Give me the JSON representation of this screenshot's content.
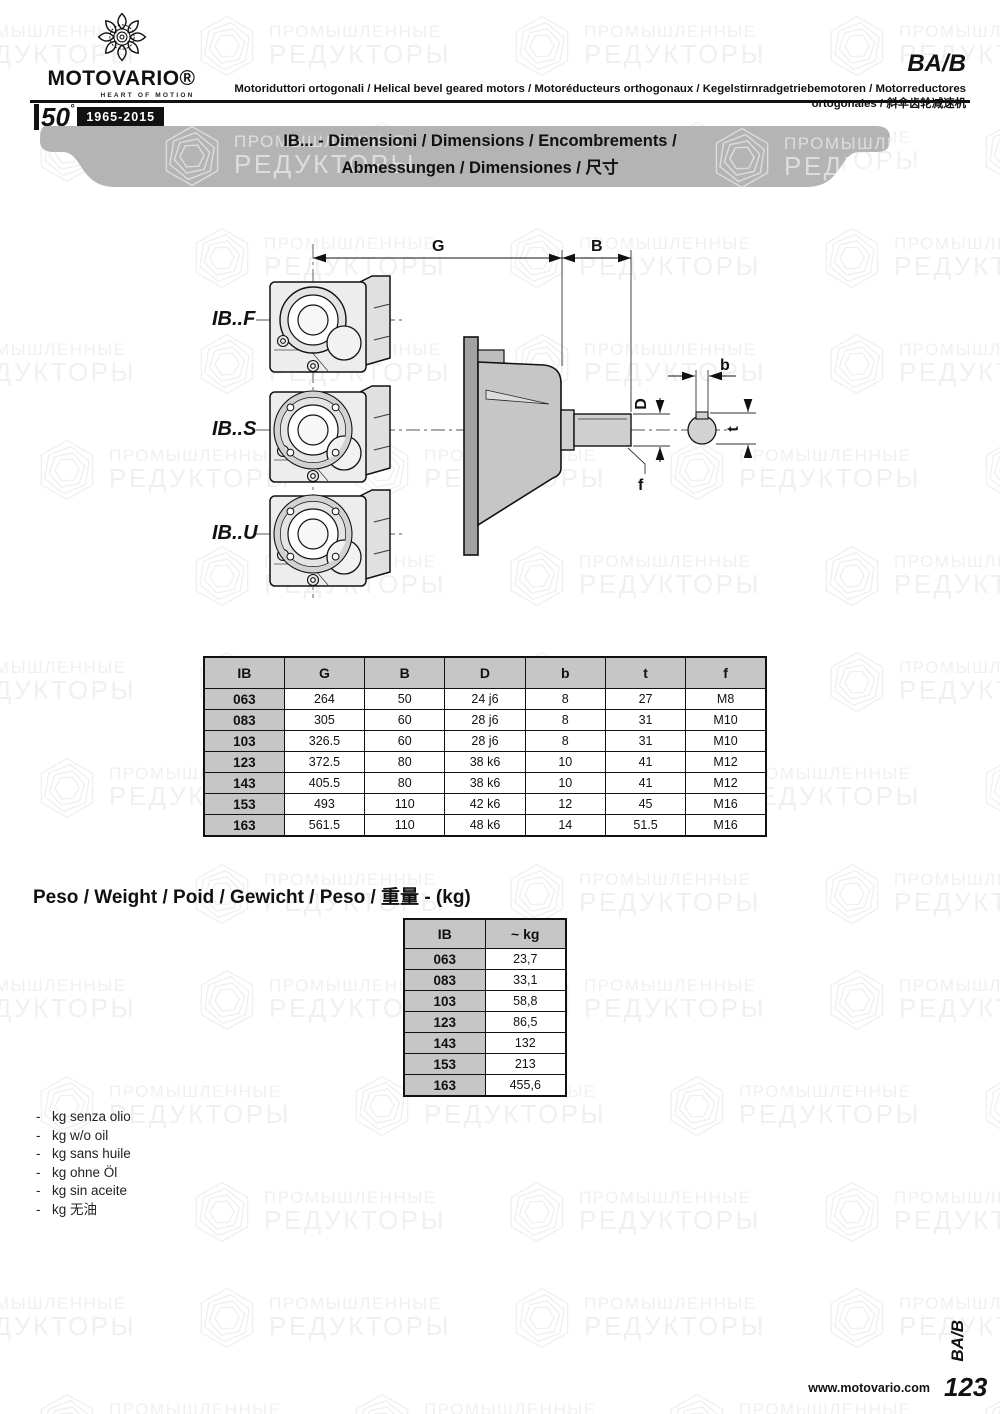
{
  "header": {
    "brand": "MOTOVARIO®",
    "tagline": "HEART OF MOTION",
    "anniversary_number": "50",
    "anniversary_mark": "°",
    "anniversary_years": "1965-2015",
    "series": "BA/B",
    "subtitle": "Motoriduttori ortogonali / Helical bevel geared motors / Motoréducteurs orthogonaux / Kegelstirnradgetriebemotoren / Motorreductores ortogonales / 斜伞齿轮减速机"
  },
  "banner": {
    "line1": "IB... - Dimensioni / Dimensions / Encombrements /",
    "line2": "Abmessungen / Dimensiones / 尺寸"
  },
  "drawings": {
    "variant_labels": [
      "IB..F",
      "IB..S",
      "IB..U"
    ],
    "dim_g": "G",
    "dim_b_len": "B",
    "dim_d": "D",
    "dim_f": "f",
    "dim_key_b": "b",
    "dim_key_t": "t"
  },
  "dimensions_table": {
    "headers": [
      "IB",
      "G",
      "B",
      "D",
      "b",
      "t",
      "f"
    ],
    "rows": [
      [
        "063",
        "264",
        "50",
        "24 j6",
        "8",
        "27",
        "M8"
      ],
      [
        "083",
        "305",
        "60",
        "28 j6",
        "8",
        "31",
        "M10"
      ],
      [
        "103",
        "326.5",
        "60",
        "28 j6",
        "8",
        "31",
        "M10"
      ],
      [
        "123",
        "372.5",
        "80",
        "38 k6",
        "10",
        "41",
        "M12"
      ],
      [
        "143",
        "405.5",
        "80",
        "38 k6",
        "10",
        "41",
        "M12"
      ],
      [
        "153",
        "493",
        "110",
        "42 k6",
        "12",
        "45",
        "M16"
      ],
      [
        "163",
        "561.5",
        "110",
        "48 k6",
        "14",
        "51.5",
        "M16"
      ]
    ]
  },
  "weight_section": {
    "title": "Peso / Weight / Poid / Gewicht / Peso / 重量 - (kg)",
    "table": {
      "headers": [
        "IB",
        "~ kg"
      ],
      "rows": [
        [
          "063",
          "23,7"
        ],
        [
          "083",
          "33,1"
        ],
        [
          "103",
          "58,8"
        ],
        [
          "123",
          "86,5"
        ],
        [
          "143",
          "132"
        ],
        [
          "153",
          "213"
        ],
        [
          "163",
          "455,6"
        ]
      ]
    },
    "notes": [
      "kg senza olio",
      "kg w/o oil",
      "kg sans huile",
      "kg ohne Öl",
      "kg sin aceite",
      "kg 无油"
    ]
  },
  "footer": {
    "website": "www.motovario.com",
    "page_number": "123",
    "series_tab": "BA/B"
  },
  "watermark": {
    "line1": "ПРОМЫШЛЕННЫЕ",
    "line2": "РЕДУКТОРЫ"
  },
  "colors": {
    "banner_gray": "#b4b4b4",
    "table_header_gray": "#c6c6c6",
    "drawing_light_gray": "#ededed",
    "side_body_gray": "#c6c6c6",
    "watermark_gray": "#f0f0f0"
  }
}
